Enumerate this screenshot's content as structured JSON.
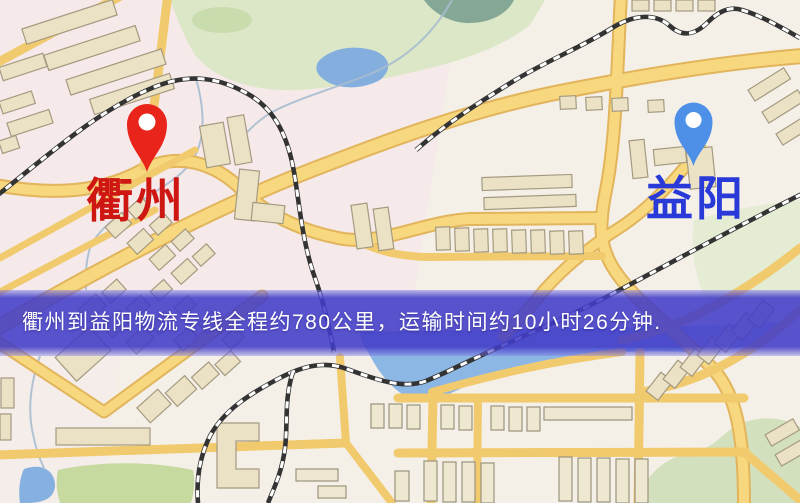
{
  "banner": {
    "text": "衢州到益阳物流专线全程约780公里，运输时间约10小时26分钟.",
    "background_color": "#423cc8",
    "text_color": "#ffffff"
  },
  "route": {
    "origin": "衢州",
    "destination": "益阳",
    "distance_text": "约780公里",
    "duration_text": "约10小时26分钟"
  },
  "markers": {
    "origin": {
      "name": "衢州",
      "pin_icon": "red-location-pin",
      "pin_color": "#e8241b",
      "label_color": "#ce1712"
    },
    "destination": {
      "name": "益阳",
      "pin_icon": "blue-location-pin",
      "pin_color": "#4e90e8",
      "label_color": "#2a3ad8"
    }
  },
  "map": {
    "colors": {
      "background": "#f4f0e8",
      "district_pink": "#f5e4ea",
      "road_yellow": "#f1ca6e",
      "park_green": "#dbe7c6",
      "hill_green": "#d3e0bd",
      "field_green": "#c6d99f",
      "water_blue": "#8cb6e4",
      "pond_teal": "#85a795",
      "building_tan": "#ebe2c6",
      "railway_dark": "#333333"
    }
  }
}
